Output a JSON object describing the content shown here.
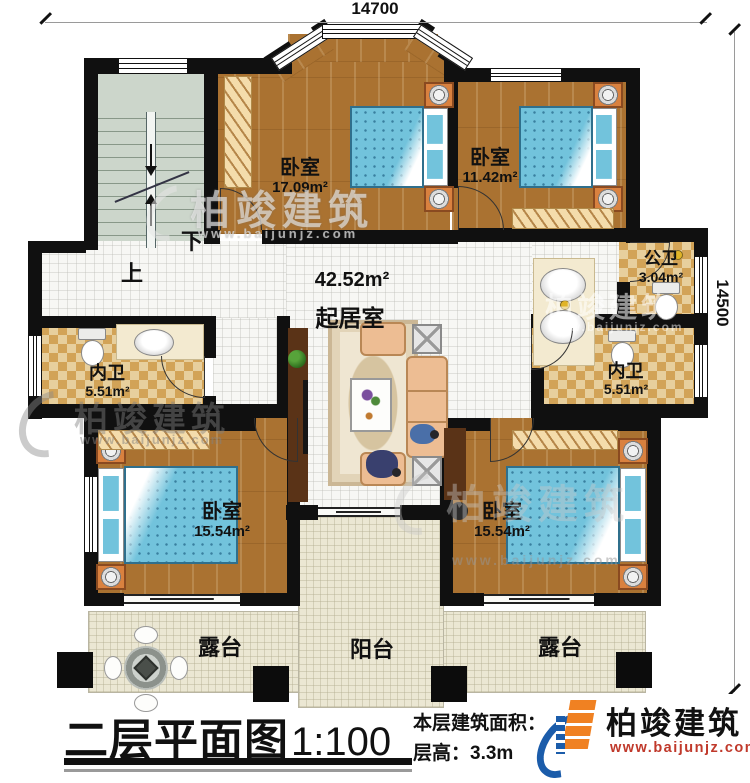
{
  "plan": {
    "dimensions": {
      "top": "14700",
      "right": "14500"
    },
    "stairs": {
      "up": "上",
      "down": "下"
    },
    "rooms": {
      "bedroom_top_left": {
        "name": "卧室",
        "area": "17.09m²"
      },
      "bedroom_top_right": {
        "name": "卧室",
        "area": "11.42m²"
      },
      "public_bath": {
        "name": "公卫",
        "area": "3.04m²"
      },
      "ensuite_left": {
        "name": "内卫",
        "area": "5.51m²"
      },
      "living": {
        "name": "起居室",
        "area": "42.52m²"
      },
      "ensuite_right": {
        "name": "内卫",
        "area": "5.51m²"
      },
      "bedroom_bottom_left": {
        "name": "卧室",
        "area": "15.54m²"
      },
      "bedroom_bottom_right": {
        "name": "卧室",
        "area": "15.54m²"
      },
      "terrace_left": {
        "name": "露台"
      },
      "balcony": {
        "name": "阳台"
      },
      "terrace_right": {
        "name": "露台"
      }
    }
  },
  "title_block": {
    "title": "二层平面图",
    "scale": "1:100",
    "area_label": "本层建筑面积：",
    "area_value": "145.7m²",
    "height_label": "层高：",
    "height_value": "3.3m"
  },
  "logo": {
    "name": "柏竣建筑",
    "website": "www.baijunjz.com"
  },
  "watermark": {
    "name": "柏竣建筑",
    "website": "www.baijunjz.com"
  },
  "colors": {
    "wall": "#101010",
    "wood": "#aa7231",
    "tile": "#f7f7f4",
    "checker_light": "#e7cf9d",
    "checker_dark": "#d2a357",
    "terrace": "#ebe7d3",
    "bed": "#72c3dc",
    "stair": "#ccd6cb",
    "logo_blue": "#1b5caa",
    "logo_orange": "#f08122",
    "logo_red": "#c0392b"
  }
}
